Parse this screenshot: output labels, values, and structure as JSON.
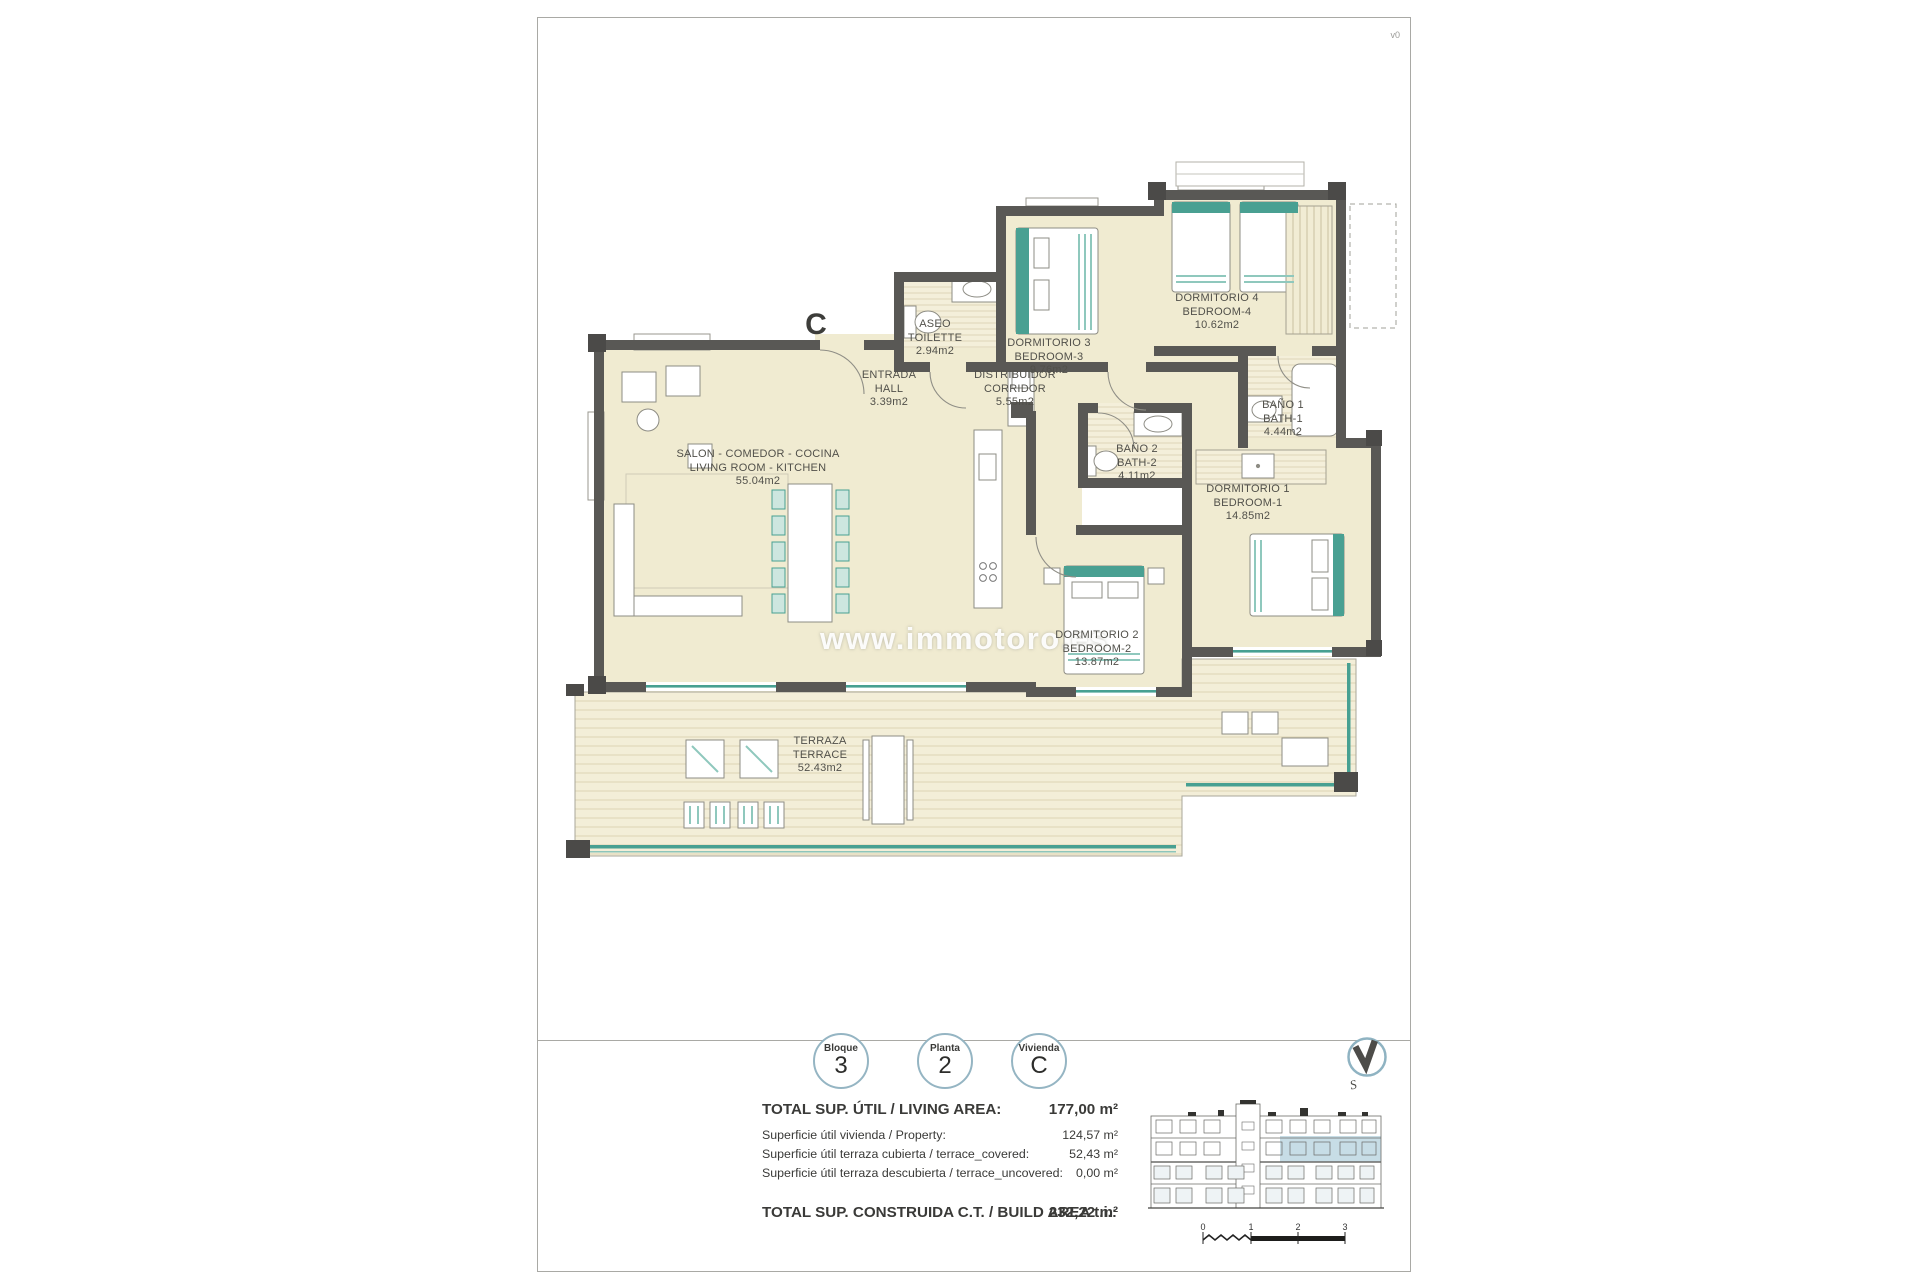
{
  "meta": {
    "version": "v0"
  },
  "plan": {
    "marker": "C",
    "watermark": "www.immotoro.es",
    "rooms": [
      {
        "name_es": "ASEO",
        "name_en": "TOILETTE",
        "area": "2.94m2"
      },
      {
        "name_es": "DORMITORIO 3",
        "name_en": "BEDROOM-3",
        "area": "9.76m2"
      },
      {
        "name_es": "DORMITORIO 4",
        "name_en": "BEDROOM-4",
        "area": "10.62m2"
      },
      {
        "name_es": "ENTRADA",
        "name_en": "HALL",
        "area": "3.39m2"
      },
      {
        "name_es": "DISTRIBUIDOR",
        "name_en": "CORRIDOR",
        "area": "5.55m2"
      },
      {
        "name_es": "SALON - COMEDOR - COCINA",
        "name_en": "LIVING ROOM - KITCHEN",
        "area": "55.04m2"
      },
      {
        "name_es": "BAÑO 2",
        "name_en": "BATH-2",
        "area": "4.11m2"
      },
      {
        "name_es": "BAÑO 1",
        "name_en": "BATH-1",
        "area": "4.44m2"
      },
      {
        "name_es": "DORMITORIO 1",
        "name_en": "BEDROOM-1",
        "area": "14.85m2"
      },
      {
        "name_es": "DORMITORIO 2",
        "name_en": "BEDROOM-2",
        "area": "13.87m2"
      },
      {
        "name_es": "TERRAZA",
        "name_en": "TERRACE",
        "area": "52.43m2"
      }
    ]
  },
  "badges": [
    {
      "label": "Bloque",
      "value": "3"
    },
    {
      "label": "Planta",
      "value": "2"
    },
    {
      "label": "Vivienda",
      "value": "C"
    }
  ],
  "summary": {
    "rows": [
      {
        "label": "TOTAL SUP. ÚTIL / LIVING AREA:",
        "value": "177,00 m²"
      },
      {
        "label": "Superficie útil vivienda / Property:",
        "value": "124,57 m²"
      },
      {
        "label": "Superficie útil terraza cubierta / terrace_covered:",
        "value": "52,43 m²"
      },
      {
        "label": "Superficie útil terraza descubierta / terrace_uncovered:",
        "value": "0,00 m²"
      }
    ],
    "total": {
      "label": "TOTAL SUP. CONSTRUIDA C.T. / BUILD AREA t.i.:",
      "value": "232,22 m²"
    }
  },
  "scalebar": {
    "ticks": [
      "0",
      "1",
      "2",
      "3"
    ]
  },
  "compass": {
    "label": "S"
  },
  "colors": {
    "wall": "#595855",
    "room_fill": "#f0ebd1",
    "accent_teal": "#47a092",
    "highlight_blue": "#c7dde6",
    "badge_ring": "#95b5c3"
  }
}
